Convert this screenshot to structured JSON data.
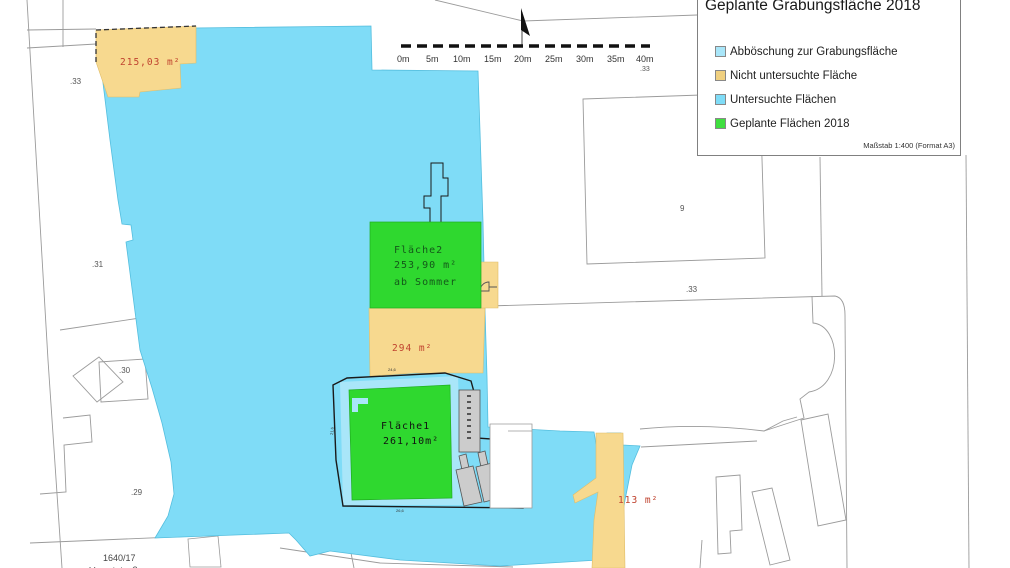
{
  "legend": {
    "title_line1": "Projekt Domplatz",
    "title_line2": "Geplante Grabungsfläche 2018",
    "items": [
      {
        "label": "Abböschung zur Grabungsfläche",
        "color": "#a9e6f9"
      },
      {
        "label": "Nicht untersuchte Fläche",
        "color": "#f0d080"
      },
      {
        "label": "Untersuchte Flächen",
        "color": "#7fdcf7"
      },
      {
        "label": "Geplante Flächen 2018",
        "color": "#3fdf3f"
      }
    ],
    "scale_note": "Maßstab 1:400 (Format A3)"
  },
  "scalebar": {
    "ticks": [
      "0m",
      "5m",
      "10m",
      "15m",
      "20m",
      "25m",
      "30m",
      "35m",
      "40m"
    ],
    "parcel_label": ".33"
  },
  "areas": {
    "area_215": "215,03 m²",
    "area_294": "294 m²",
    "area_113": "113 m²",
    "flaeche2": {
      "name": "Fläche2",
      "size": "253,90 m²",
      "note": "ab Sommer"
    },
    "flaeche1": {
      "name": "Fläche1",
      "size": "261,10m²"
    }
  },
  "parcels": {
    "p33_left": ".33",
    "p31": ".31",
    "p30": ".30",
    "p29": ".29",
    "p1640_17": "1640/17",
    "p9": "9",
    "p33_mid": ".33",
    "street": "Hauptstraße"
  },
  "dims": {
    "top": "24,6",
    "bottom": "26,6",
    "left": "21,6"
  },
  "colors": {
    "untersuchte_flaechen": "#7fdcf7",
    "abboeschung": "#a9e6f9",
    "nicht_untersucht": "#f7d98f",
    "geplant_2018": "#2fd82f",
    "area_label_red": "#c0432f"
  }
}
